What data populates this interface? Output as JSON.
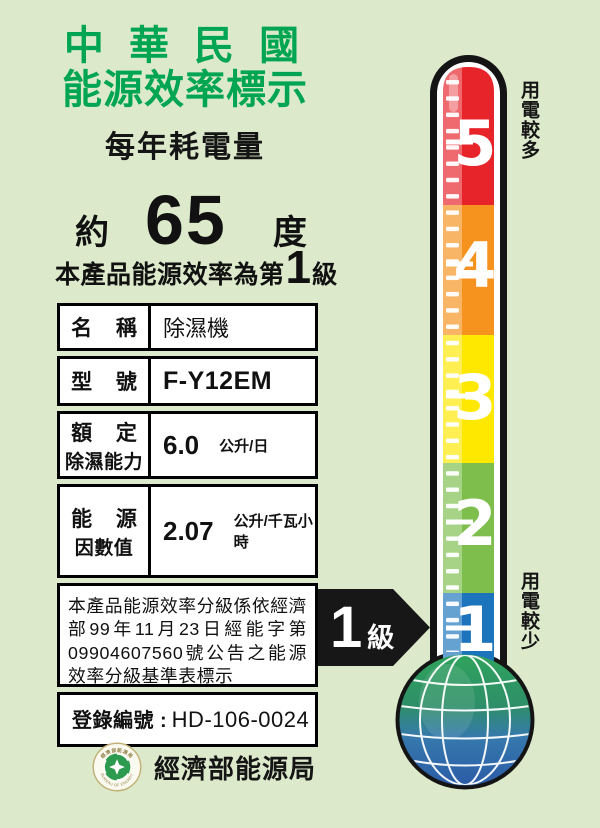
{
  "header": {
    "title_line1": "中 華 民 國",
    "title_line2": "能源效率標示",
    "subtitle": "每年耗電量",
    "consumption": {
      "prefix": "約",
      "value": "65",
      "unit": "度"
    },
    "grade_sentence": {
      "before": "本產品能源效率為第",
      "grade": "1",
      "after": "級"
    }
  },
  "table": {
    "rows": [
      {
        "label": "名 稱",
        "value": "除濕機"
      },
      {
        "label": "型 號",
        "value": "F-Y12EM"
      },
      {
        "label": "額 定",
        "label2": "除濕能力",
        "value": "6.0",
        "unit": "公升/日"
      },
      {
        "label": "能 源",
        "label2": "因數值",
        "value": "2.07",
        "unit": "公升/千瓦小時"
      }
    ],
    "note": "本產品能源效率分級係依經濟部99年11月23日經能字第09904607560號公告之能源效率分級基準表標示",
    "registration_label": "登錄編號 :",
    "registration_value": "HD-106-0024"
  },
  "thermometer": {
    "levels": [
      {
        "value": "5",
        "color": "#E8242B"
      },
      {
        "value": "4",
        "color": "#F6921E"
      },
      {
        "value": "3",
        "color": "#FFE800"
      },
      {
        "value": "2",
        "color": "#7DBE4C"
      },
      {
        "value": "1",
        "color": "#1C75BC"
      }
    ],
    "top_label": "用電較多",
    "bottom_label": "用電較少",
    "arrow": {
      "grade": "1",
      "suffix": "級"
    }
  },
  "footer": {
    "agency": "經濟部能源局",
    "logo_ring_top": "經濟部能源局",
    "logo_ring_bottom": "BUREAU OF ENERGY"
  },
  "colors": {
    "background": "#DCE9CB",
    "title_green": "#00A551",
    "globe_green": "#2FA35C",
    "globe_blue": "#2A5AA6"
  }
}
